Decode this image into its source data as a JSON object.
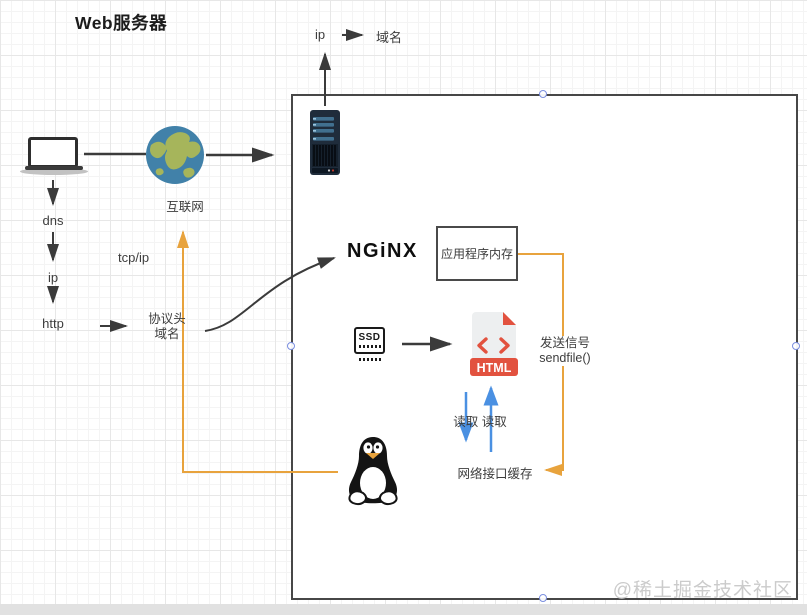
{
  "title": "Web服务器",
  "watermark": "@稀土掘金技术社区",
  "labels": {
    "ip_top": "ip",
    "domain_top": "域名",
    "internet": "互联网",
    "dns": "dns",
    "ip": "ip",
    "http": "http",
    "tcpip": "tcp/ip",
    "protocol_l1": "协议头",
    "protocol_l2": "域名",
    "nginx": "NGiNX",
    "app_memory": "应用程序内存",
    "send_l1": "发送信号",
    "send_l2": "sendfile()",
    "read": "读取 读取",
    "nic_cache": "网络接口缓存",
    "ssd": "SSD",
    "html_banner": "HTML"
  },
  "colors": {
    "connector_orange": "#E8A33D",
    "connector_blue": "#4A90E2",
    "connector_dark": "#3B3B3B",
    "file_red": "#E2523F",
    "server_navy": "#1F2C3B",
    "globe_sea": "#4181A9",
    "globe_land": "#A6B55B",
    "selection_handle": "#7B8FE0"
  },
  "icons": [
    "laptop-icon",
    "globe-icon",
    "server-icon",
    "ssd-icon",
    "html-file-icon",
    "tux-linux-icon",
    "code-brackets-icon"
  ]
}
